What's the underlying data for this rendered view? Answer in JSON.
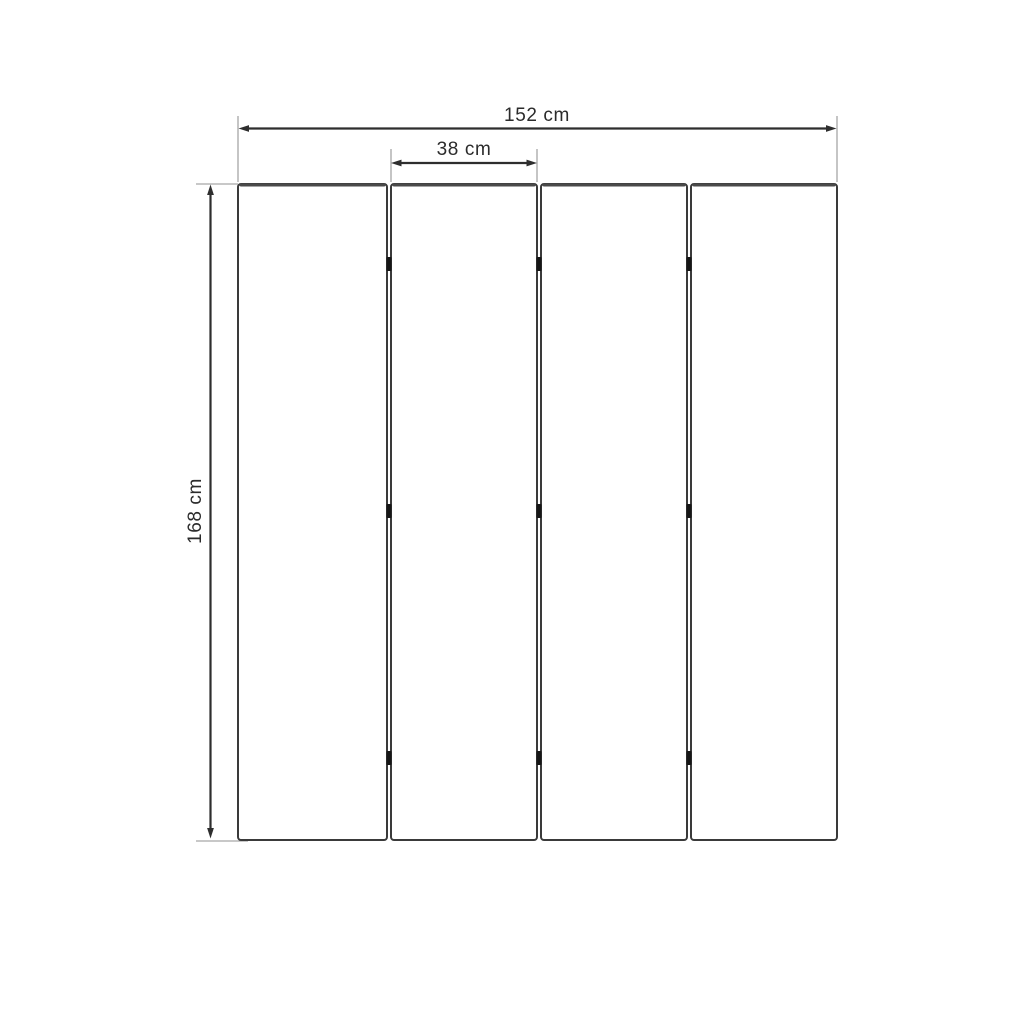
{
  "diagram": {
    "subject": "four-panel folding screen front view with dimensions",
    "dimensions": {
      "total_width_label": "152 cm",
      "panel_width_label": "38 cm",
      "height_label": "168 cm",
      "total_width_value": 152,
      "panel_width_value": 38,
      "height_value": 168,
      "unit": "cm"
    },
    "panel_count": 4,
    "hinge_joints": 3,
    "hinges_per_joint": 3,
    "colors": {
      "background": "#ffffff",
      "panel_outline": "#3a3a3a",
      "panel_top_edge": "#4a4a4a",
      "dimension_line": "#2e2e2e",
      "extension_line": "#a6a6a6",
      "hinge": "#161616",
      "text": "#2b2b2b"
    }
  }
}
